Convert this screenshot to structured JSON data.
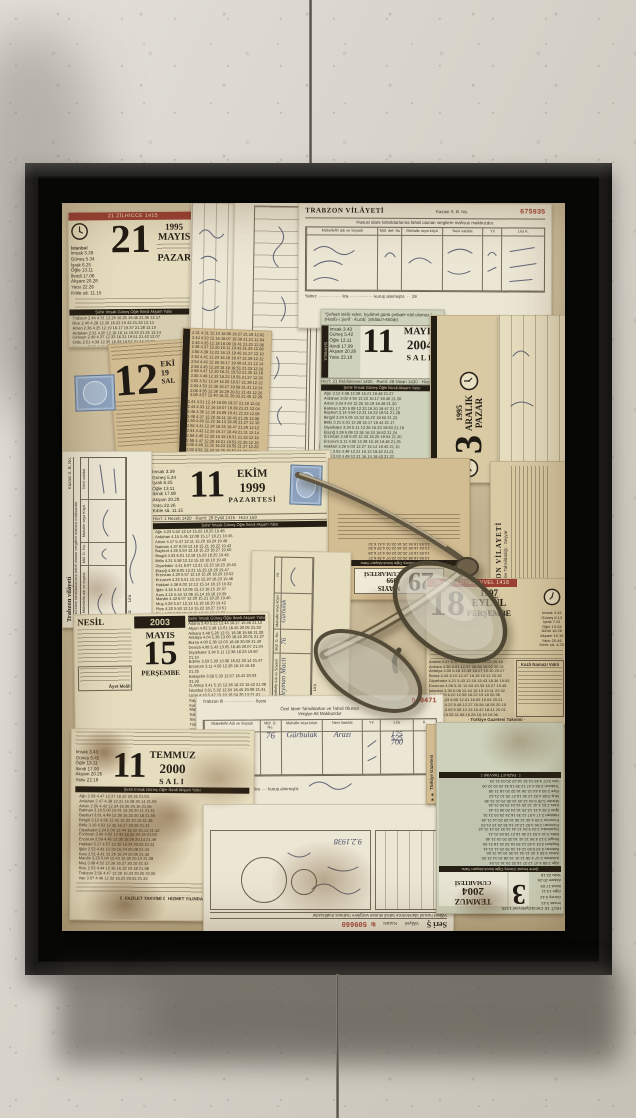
{
  "scene": {
    "description": "Framed mixed-media collage of vintage Turkish tear-off calendar leaves and provincial tax receipts with a pair of folded reading glasses, hung on a textured plaster wall",
    "wall_color": "#d8d3c8",
    "frame_color": "#1b1a18",
    "canvas_tone": "#d0c19e"
  },
  "t": {
    "header6": "Şehir İmsak Güneş Öğle İkindi Akşam Yatsı",
    "east_may": [
      "Ağrı 3.12 4.58 12.29 16.21 19.49 21.27",
      "Ardahan 3.02 4.50 12.23 16.17 19.46 21.26",
      "Artvin 3.04 4.54 12.26 16.19 19.49 21.30",
      "Batman 3.30 5.08 12.33 16.20 19.47 21.17",
      "Bayburt 3.14 4.59 12.31 16.22 19.51 21.28",
      "Bingöl 3.24 5.05 12.33 16.22 19.50 21.23",
      "Bitlis 3.21 5.01 12.28 16.17 19.44 21.17",
      "Diyarbakır 3.34 5.11 12.36 16.23 19.50 21.19",
      "Elazığ 3.29 5.09 12.36 16.24 19.52 21.24",
      "Erzincan 3.18 5.02 12.34 16.25 19.54 21.30",
      "Erzurum 3.11 4.56 12.28 16.19 19.48 21.25",
      "Hakkari 3.26 5.03 12.27 16.14 19.40 21.10",
      "Iğdır 3.03 4.49 12.21 16.13 19.42 21.21",
      "Kars 3.02 4.49 12.21 16.14 19.43 21.22",
      "Mardin 3.34 5.11 12.35 16.21 19.47 21.15",
      "Muş 3.19 5.00 12.28 16.17 19.45 21.19",
      "Rize 3.06 4.55 12.28 16.22 19.52 21.33",
      "Siirt 3.27 5.05 12.31 16.18 19.44 21.14",
      "Şırnak 3.28 5.05 12.29 16.15 19.41 21.10",
      "Trabzon 3.09 4.58 12.31 16.24 19.54 21.35",
      "Van 3.17 4.57 12.24 16.13 19.39 21.11"
    ],
    "east_oct": [
      "Ağrı 4.23 5.52 12.14 15.22 18.25 19.48",
      "Ardahan 4.15 5.45 12.08 15.17 18.21 19.45",
      "Artvin 4.17 5.47 12.11 15.20 18.24 19.48",
      "Batman 4.37 6.03 12.18 15.21 18.22 19.42",
      "Bayburt 4.25 5.54 12.16 15.23 18.27 19.50",
      "Bingöl 4.33 6.01 12.18 15.23 18.25 19.46",
      "Bitlis 4.31 5.58 12.13 15.18 18.19 19.40",
      "Diyarbakır 4.41 6.07 12.21 15.23 18.23 19.43",
      "Elazığ 4.38 6.05 12.21 15.25 18.26 19.47",
      "Erzincan 4.29 5.57 12.19 15.26 18.29 19.52",
      "Erzurum 4.22 5.51 12.13 15.20 18.23 19.46",
      "Hakkari 4.36 6.02 12.12 15.14 18.13 19.32",
      "Iğdır 4.16 5.44 12.06 15.13 18.15 19.37",
      "Kars 4.15 5.44 12.06 15.14 18.16 19.39",
      "Mardin 4.42 6.07 12.20 15.21 18.20 19.40",
      "Muş 4.29 5.57 12.13 15.18 18.20 19.42",
      "Rize 4.20 5.50 12.13 15.22 18.27 19.51",
      "Siirt 4.36 6.03 12.16 15.18 18.18 19.38",
      "Şırnak 4.37 6.03 12.14 15.15 18.14 19.33",
      "Trabzon 4.23 5.53 12.16 15.25 18.29 19.54",
      "Van 4.27 5.54 12.09 15.13 18.13 19.33"
    ],
    "east_jul": [
      "Ağrı 2.58 4.47 12.37 16.32 20.16 21.54",
      "Ardahan 2.47 4.38 12.31 16.28 20.14 21.55",
      "Artvin 2.50 4.42 12.34 16.30 20.16 21.56",
      "Batman 3.19 5.00 12.41 16.30 20.11 21.41",
      "Bayburt 3.01 4.49 12.39 16.33 20.18 21.55",
      "Bingöl 3.12 4.56 12.41 16.32 20.15 21.48",
      "Bitlis 3.10 4.53 12.36 16.27 20.09 21.41",
      "Diyarbakır 3.24 5.04 12.44 16.32 20.13 21.42",
      "Erzincan 3.06 4.52 12.42 16.35 20.19 21.53",
      "Erzurum 2.59 4.46 12.36 16.29 20.14 21.49",
      "Hakkari 3.17 4.57 12.35 16.24 20.03 21.31",
      "Iğdır 2.52 4.41 12.29 16.24 20.08 21.44",
      "Kars 2.51 4.41 12.29 16.24 20.09 21.45",
      "Mardin 3.25 5.04 12.43 16.30 20.10 21.38",
      "Muş 3.08 4.52 12.36 16.27 20.10 21.42",
      "Rize 2.53 4.44 12.36 16.32 20.18 21.58",
      "Trabzon 2.56 4.47 12.39 16.34 20.20 22.00",
      "Van 3.07 4.49 12.32 16.22 20.03 21.33"
    ],
    "national_may": [
      "Adana 3.49 5.22 12.44 16.27 19.46 21.12",
      "Afyon 4.02 5.38 13.01 16.45 20.05 21.33",
      "Ankara 3.48 5.26 12.51 16.36 19.58 21.28",
      "Antalya 4.04 5.38 13.00 16.42 20.01 21.27",
      "Bursa 4.00 5.38 13.03 16.48 20.09 21.40",
      "Denizli 4.08 5.43 13.05 16.48 20.07 21.34",
      "Diyarbakır 3.34 5.11 12.36 16.23 19.50 21.19",
      "Edirne 3.59 5.39 13.06 16.52 20.14 21.47",
      "Erzurum 3.11 4.56 12.28 16.19 19.48 21.25",
      "Eskişehir 3.56 5.33 12.57 16.42 20.03 21.32",
      "G.Antep 3.41 5.15 12.38 16.22 19.42 21.08",
      "İstanbul 3.51 5.32 12.59 16.45 20.08 21.41",
      "İzmir 4.10 5.47 13.10 16.54 20.13 21.41",
      "Kayseri 3.42 5.18 12.42 16.26 19.47 21.15",
      "Konya 3.54 5.30 12.53 16.37 19.56 21.23",
      "Malatya 3.33 5.10 12.35 16.20 19.41 21.08",
      "Samsun 3.31 5.12 12.39 16.26 19.49 21.21",
      "Sivas 3.36 5.14 12.39 16.24 19.46 21.16",
      "Trabzon 3.09 4.58 12.31 16.24 19.54 21.35",
      "Van 3.17 4.57 12.24 16.13 19.39 21.11"
    ],
    "national_sep": [
      "Adana 4.47 6.09 12.41 16.08 19.02 20.18",
      "Ankara 4.36 6.01 12.37 16.06 19.02 20.21",
      "Antalya 4.55 6.18 12.49 16.17 19.10 20.27",
      "Bursa 4.44 6.10 12.47 16.15 19.12 20.32",
      "Diyarbakır 4.21 5.43 12.15 15.43 18.36 19.53",
      "Erzurum 4.08 5.31 12.04 15.33 18.27 19.45",
      "İstanbul 4.39 6.06 12.44 16.13 19.11 20.32",
      "İzmir 4.55 6.20 12.55 16.22 19.18 20.36",
      "Konya 4.43 6.06 12.41 16.09 19.04 20.21",
      "Samsun 4.22 5.48 12.27 15.56 18.55 20.15",
      "Trabzon 4.09 5.35 12.13 15.42 18.41 20.01",
      "Van 4.04 5.26 11.58 15.26 18.19 19.36"
    ],
    "numeric": [
      "2.41 4.31 12.14 16.05 19.37 21.19 12.02",
      "2.44 4.33 12.16 16.07 19.39 21.21 12.04",
      "2.46 4.35 12.18 16.09 19.41 21.23 12.06",
      "2.48 4.37 12.20 16.11 19.43 21.25 12.08",
      "2.50 4.39 12.22 16.13 19.45 21.27 12.10",
      "2.52 4.41 12.24 16.15 19.47 21.29 12.12",
      "2.54 4.43 12.26 16.17 19.49 21.31 12.14",
      "2.56 4.45 12.28 16.19 19.51 21.33 12.16",
      "2.58 4.47 12.30 16.21 19.53 21.35 12.18",
      "3.00 4.49 12.32 16.23 19.55 21.37 12.20",
      "3.02 4.51 12.34 16.25 19.57 21.39 12.22",
      "3.04 4.53 12.36 16.27 19.59 21.41 12.24",
      "3.06 4.55 12.38 16.29 20.01 21.43 12.26",
      "3.08 4.57 12.40 16.31 20.03 21.45 12.28"
    ]
  },
  "p": {
    "cal1995": {
      "banner": "21 ZİLHİCCE 1415",
      "day": "21",
      "year": "1995",
      "month": "MAYIS",
      "weekday": "PAZAR",
      "city": "İstanbul",
      "times": [
        "İmsak 3.39",
        "Güneş 5.34",
        "İşrak 6.25",
        "Öğle 13.11",
        "İkindi 17.08",
        "Akşam 20.28",
        "Yatsı 22.26",
        "Kıble sâ. 11.15"
      ],
      "rows": [
        "Trabzon 2.44 4.31 12.29 16.25 19.45 21.35 12.17",
        "Rize 2.40 4.28 12.26 16.22 19.42 21.32 12.14",
        "Artvin 2.36 4.25 12.19 16.17 19.37 21.28 12.10",
        "Ardahan 2.31 4.20 12.16 16.14 19.33 21.25 12.14",
        "Giresun 2.49 4.37 12.33 16.31 19.51 21.42 12.07",
        "Ordu 2.51 4.39 12.35 16.33 19.52 21.44 12.27",
        "Amasya 2.55 4.42 12.40 16.40 19.58 21.50 12.16",
        "Tokat 2.56 4.46 12.40 16.37 19.55 21.46 12.26",
        "Sinop 2.54 4.40 12.41 16.43 20.05 22.01 12.16",
        "Samsun 2.55 4.44 12.41 16.41 19.59 21.50 12.18"
      ],
      "footer": "···· Türkiye Gazetesi Takvimi ····"
    },
    "receiptTop": {
      "title": "TRABZON VİLÂYETİ",
      "kaza": "Kazası  S. B. No.",
      "serial": "675935",
      "subtitle": "Hususi idare tahsildarlarına tahsil olunan vergilere mahsus makbuzdur.",
      "h1": "Mükellefin adı ve Soyadı",
      "h2": "Müf. def. No",
      "h3": "Mahalle veya köyü",
      "h4": "Nevi varidat",
      "h5": "Yıl",
      "h6": "Lira  K.",
      "footer": "Yalnız ················ lira ················ kuruş alınmıştır.        · ·  19"
    },
    "receiptAB": {
      "seri": "Seri",
      "code": "AB",
      "title": "Vilâyeti ·············· Kazası ··············",
      "subtitle": "Tahsildar tarafından tahsil olunan vergilere mahsus makbuzdur",
      "makbuz": "Makbuz",
      "icmal": "İcmal"
    },
    "cal12": {
      "day": "12",
      "month": "EKİ",
      "year": "19",
      "weekday": "SAL"
    },
    "cal2004m": {
      "quote": "“Şefaati inkâr eden, kıyâmet günü şefaate nâil olamaz.” (Hadîs-i Şerîf · Kuzâî, Şihâbü'l-Ahbâr)",
      "side": "İSTANBUL",
      "times": [
        "İmsak 3.43",
        "Güneş 5.42",
        "Öğle 13.11",
        "İkindi 17.09",
        "Akşam 20.26",
        "Yatsı 22.18"
      ],
      "day": "11",
      "month": "MAYIS",
      "year": "2004",
      "weekday": "SALI",
      "hicri": "Hicrî: 21 Rebîülevvel 1425 · Rumî: 28 Nisan 1420 · Hızır 6"
    },
    "cal3aralik": {
      "day": "3",
      "year": "1995",
      "month": "ARALIK",
      "weekday": "PAZAR"
    },
    "ledgerRight": {
      "note": "kuruş alınmıştır. 194",
      "lira": "Lira"
    },
    "cal1999": {
      "day": "11",
      "month": "EKİM",
      "year": "1999",
      "weekday": "PAZARTESİ",
      "hicri": "Hicrî: 1 Receb 1420 · Rumî: 28 Eylül 1415 · Hızır 159",
      "footer": "☾ FAZİLET TAKVİMİ ☾ 33. HİZMET YILINDA"
    },
    "trabzonLeft": {
      "title": "Trabzon vilâyeti",
      "kaza": "Kazası  S. B. No.",
      "subtitle": "Hususi idare tahsildarlarınca tahsil olunan vergilere mahsus makbuzdur",
      "h1": "Mükellefin adı ve soyadı",
      "h2": "Müf. D. No.",
      "h3": "Mahalle veya Köyü",
      "h4": "Nevi varidat",
      "yalniz": "Yalnız",
      "lira": "Lira"
    },
    "cal29": {
      "day": "29",
      "month": "MAYIS",
      "year": "1999",
      "weekday": "CUMARTESİ",
      "rows": [
        "13.06 16.58 20.22 22.07 4.35 6.27",
        "13.05 16.57 20.20 22.05 4.37 6.28",
        "13.04 16.55 20.18 22.03 4.39 6.30",
        "13.03 16.54 20.16 22.01 4.41 6.32"
      ]
    },
    "trabzonSide": {
      "title": "TRABZON VİLAYETİ",
      "line": "Hususî Muhasebe Tahsildarlığı · Seyyar"
    },
    "cal18": {
      "banner": "16 CEMAZİYELEVVEL 1418",
      "day": "18",
      "year": "1997",
      "month": "EYLÜL",
      "weekday": "PERŞEMBE",
      "times": [
        "İmsak 4.43",
        "Güneş 6.13",
        "İşrak 7.01",
        "Öğle 13.04",
        "İkindi 16.28",
        "Akşam 19.16",
        "Yatsı 20.46",
        "Kıble sâ. 4.20"
      ],
      "boxTitle": "Kazâ Namazı Vakti",
      "footer": "· Türkiye Gazetesi Takvimi ·"
    },
    "cal2003": {
      "brand": "NESİL",
      "yearbox": "2003",
      "month": "MAYIS",
      "day": "15",
      "weekday": "PERŞEMBE",
      "noteLabel": "Âyet Meâli"
    },
    "receipt910471": {
      "city": "Trabzon İli",
      "dots": "·····················",
      "ilce": "İlçesi",
      "line1": "Özel İdare Tahsildarları ve Tahsil Olunan",
      "line2": "Vergiye Ait Makbuzdur",
      "serial": "910471",
      "h1": "Mükellefin Adı ve Soyadı",
      "h2": "Müf. D. No.",
      "h3": "Mahalle veya köyü",
      "h4": "Nevi Varidat",
      "h5": "Yıl",
      "h6": "Lira",
      "h7": "K.",
      "hwName": "Süleyman Macit",
      "hwNo": "76",
      "hwKoy": "Gürbulak",
      "hwNevi": "Arazi",
      "hwAmounts": [
        "175",
        "525",
        "700"
      ],
      "yalniz": "Yalnız",
      "hwYalniz": "yediyüz",
      "kurus": "lira ···· kuruş alınmıştır."
    },
    "cal2000": {
      "day": "11",
      "month": "TEMMUZ",
      "year": "2000",
      "weekday": "SALI",
      "footer": "☾ FAZİLET TAKVİMİ ☾ HİZMET YILINDA"
    },
    "receiptUD": {
      "seri": "Seri Ş",
      "vilayet": "Vilâyeti",
      "kaza": "Kazası",
      "no": "№ 509660",
      "subtitle": "Vilâyet hususî idarelerince tahsil olunan vergilere mahsus makbuzdur",
      "dateHw": "9.2.1938"
    },
    "cal2004t": {
      "day": "3",
      "month": "TEMMUZ",
      "year": "2004",
      "weekday": "CUMARTESİ",
      "hicri": "Hicrî: 15 Cemâziyelevvel 1425",
      "footer": "☾ FAZİLET TAKVİMİ ☾",
      "strip": "✶✶ Türkiye Gazetesi"
    }
  }
}
